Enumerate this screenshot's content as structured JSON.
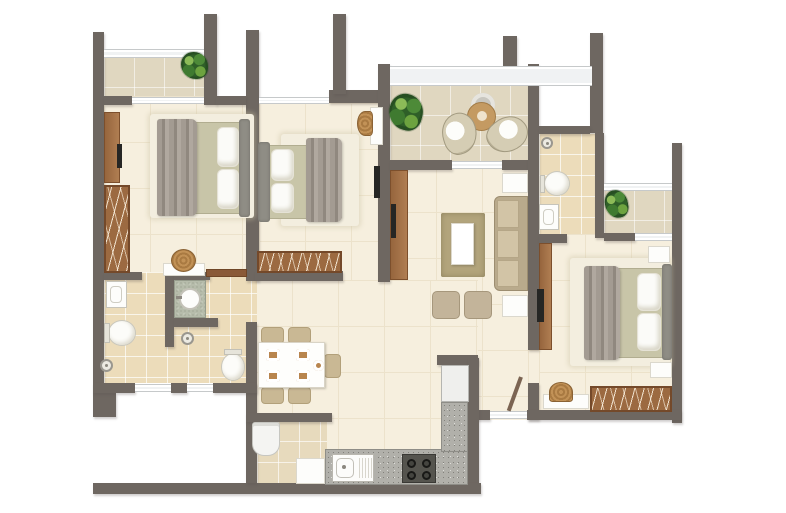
{
  "meta": {
    "title": "Apartment floor plan — 3 bedroom unit, top view",
    "image_type": "architectural floor plan rendering",
    "text_labels": [],
    "canvas": {
      "width": 786,
      "height": 513
    }
  },
  "palette": {
    "wall": "#6e6761",
    "floorCream": "#f6efde",
    "floorGrout": "#ece2cb",
    "tileBalcony": "#e0d7c0",
    "tileBath": "#ecdcba",
    "tileKitchen": "#e7dabd",
    "windowGlass": "#f0f2f3",
    "windowFrame": "#c6c9ca",
    "wood": "#9c6a41",
    "mattress": "#c8c5a8",
    "headboard": "#8f8d85",
    "blanket": "#a39b92",
    "pillow": "#fbfbf8",
    "bedRug": "#f3eedf",
    "livingRug": "#b2a47c",
    "tan": "#c9b894",
    "pouf": "#c3b49a",
    "counter": "#b1b0aa",
    "counterSpeck": "#82817b",
    "stone": "#b6bcab",
    "tv": "#262624",
    "plantGreen": "#2f5f28",
    "rattanWood": "#a97a42"
  },
  "apartment": {
    "unit_type": "3-bedroom apartment",
    "rooms": [
      {
        "name": "Bedroom 1 (top-left)",
        "items": [
          "double bed with grey throw",
          "striped wardrobe",
          "wall TV panel",
          "rattan stool with vanity shelf"
        ]
      },
      {
        "name": "Bedroom 2 (centre)",
        "items": [
          "double bed with grey throw",
          "striped wardrobe",
          "dressing table",
          "rattan stool",
          "wall TV"
        ]
      },
      {
        "name": "Master bedroom (right)",
        "items": [
          "double bed with grey throw",
          "striped wardrobe",
          "two nightstands",
          "dressing counter",
          "rattan stool",
          "TV cabinet"
        ]
      },
      {
        "name": "Living room",
        "items": [
          "three-seat sofa",
          "two end tables",
          "rug with coffee table",
          "two poufs",
          "TV cabinet"
        ]
      },
      {
        "name": "Dining area",
        "items": [
          "six-seat table with place settings",
          "five chairs"
        ]
      },
      {
        "name": "Kitchen",
        "items": [
          "L-shaped granite counter",
          "sink with drainboard",
          "four-burner hob",
          "refrigerator",
          "washing machine",
          "base cabinet"
        ]
      },
      {
        "name": "Bathroom 1 (left)",
        "items": [
          "wall basin",
          "toilet",
          "shower head"
        ]
      },
      {
        "name": "Bathroom 2 (common)",
        "items": [
          "countertop round basin",
          "toilet",
          "shower head"
        ]
      },
      {
        "name": "Ensuite bathroom (master)",
        "items": [
          "wall basin",
          "toilet",
          "shower head"
        ]
      },
      {
        "name": "Main balcony",
        "items": [
          "two bowl lounge chairs",
          "round side table",
          "potted plant"
        ]
      },
      {
        "name": "Bedroom 1 balcony",
        "items": [
          "potted plant"
        ]
      },
      {
        "name": "Master balcony",
        "items": [
          "potted plant"
        ]
      }
    ]
  }
}
